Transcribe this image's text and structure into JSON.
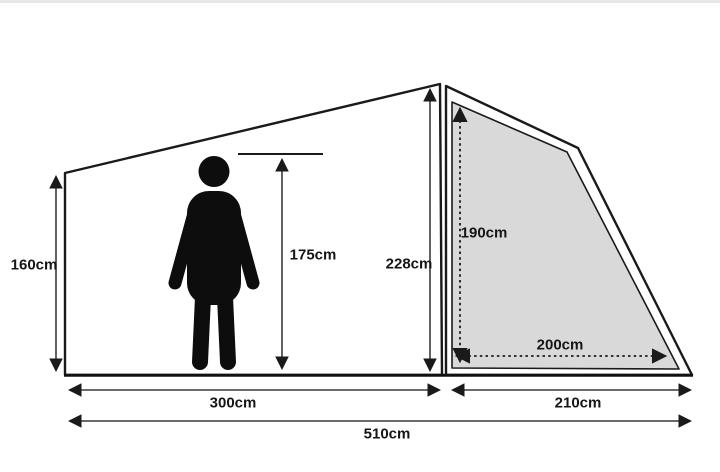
{
  "diagram": {
    "type": "tent-dimension-diagram",
    "unit": "cm",
    "colors": {
      "background": "#ffffff",
      "outline": "#1a1a1a",
      "panel_fill": "#d9d9d9",
      "dimension_line": "#3a3a3a",
      "figure_fill": "#0d0d0d",
      "label_color": "#161616"
    },
    "icons": {
      "person": "standing-person-silhouette-icon"
    },
    "measurements": {
      "left_wall_height": "160cm",
      "person_height": "175cm",
      "peak_height": "228cm",
      "panel_height": "190cm",
      "panel_width": "200cm",
      "main_section_length": "300cm",
      "porch_section_length": "210cm",
      "total_length": "510cm"
    }
  }
}
